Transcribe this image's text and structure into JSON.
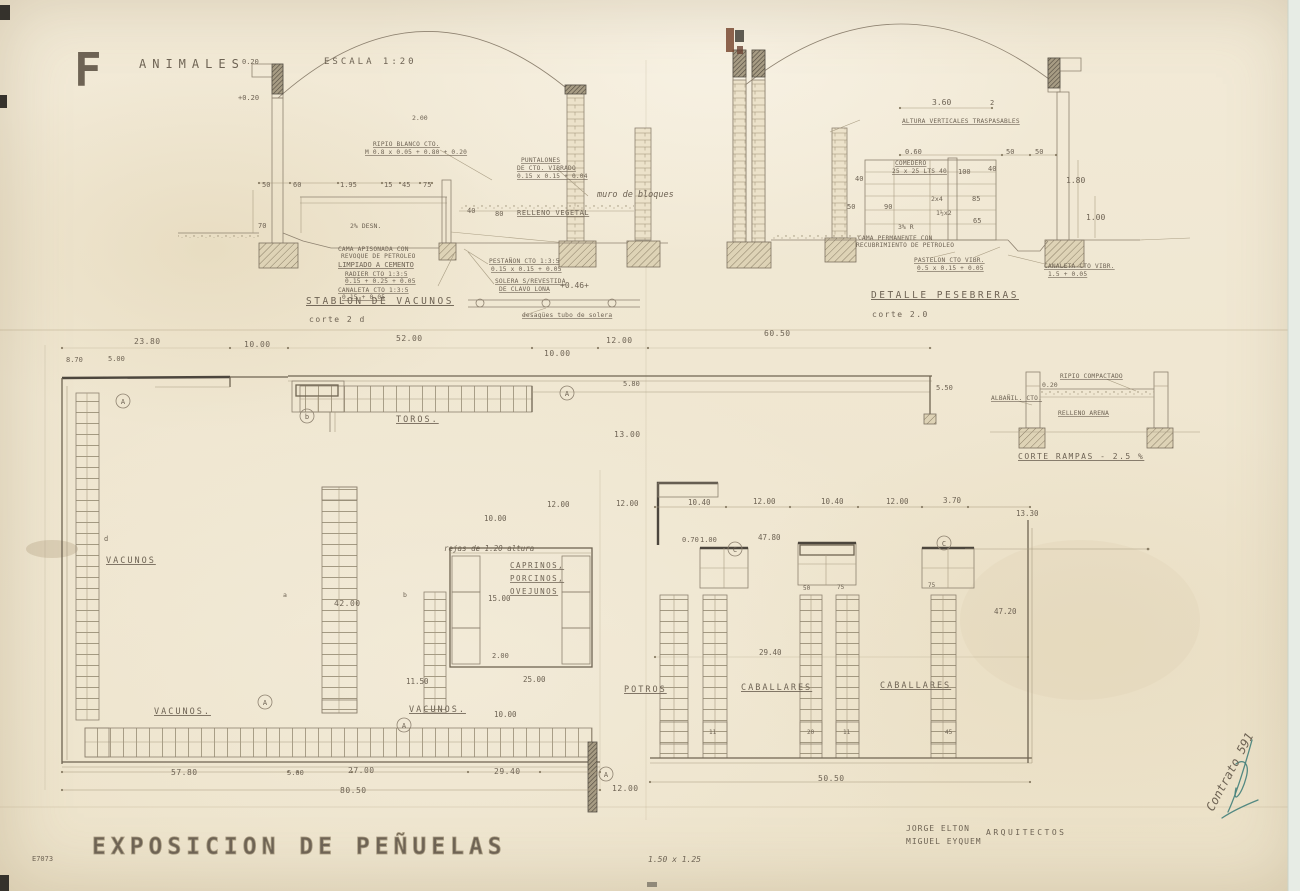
{
  "palette": {
    "paper": "#f1e9d5",
    "ink_faint": "#9b8f77",
    "ink": "#6f6452",
    "dark": "#4c463d",
    "blue_ink": "#43807a",
    "scanner_edge": "#e7ece5"
  },
  "drawing": {
    "header": [
      {
        "n": "sheet-letter",
        "t": "F",
        "x": 74,
        "y": 86,
        "c": "sheet-f"
      },
      {
        "n": "drawing-title",
        "t": "ANIMALES",
        "x": 139,
        "y": 68,
        "c": "head"
      },
      {
        "n": "scale-note",
        "t": "ESCALA  1:20",
        "x": 324,
        "y": 64,
        "c": "head-sm"
      },
      {
        "n": "dim-label",
        "t": "0.20",
        "x": 242,
        "y": 64,
        "c": "tiny"
      },
      {
        "n": "dim-label",
        "t": "+0.20",
        "x": 238,
        "y": 100,
        "c": "tiny"
      }
    ],
    "section_vacunos": [
      {
        "t": "2.00",
        "x": 412,
        "y": 120,
        "c": "tiny-f"
      },
      {
        "n": "note",
        "t": "RIPIO BLANCO CTO.",
        "x": 373,
        "y": 146,
        "c": "ann-u"
      },
      {
        "n": "note",
        "t": "M 0.8 x 0.05 + 0.80 + 0.20",
        "x": 365,
        "y": 154,
        "c": "ann-u"
      },
      {
        "t": "50",
        "x": 262,
        "y": 187,
        "c": "tiny"
      },
      {
        "t": "60",
        "x": 293,
        "y": 187,
        "c": "tiny"
      },
      {
        "t": "1.95",
        "x": 340,
        "y": 187,
        "c": "tiny"
      },
      {
        "t": "15",
        "x": 384,
        "y": 187,
        "c": "tiny"
      },
      {
        "t": "45",
        "x": 402,
        "y": 187,
        "c": "tiny"
      },
      {
        "t": "75",
        "x": 423,
        "y": 187,
        "c": "tiny"
      },
      {
        "t": "70",
        "x": 258,
        "y": 228,
        "c": "tiny"
      },
      {
        "n": "note",
        "t": "PUNTALONES",
        "x": 521,
        "y": 162,
        "c": "ann-u"
      },
      {
        "n": "note",
        "t": "DE CTO. VIBRADO",
        "x": 517,
        "y": 170,
        "c": "ann-u"
      },
      {
        "n": "note",
        "t": "0.15 x 0.15 + 0.04",
        "x": 517,
        "y": 178,
        "c": "ann-u"
      },
      {
        "n": "note-hand",
        "t": "muro de bloques",
        "x": 597,
        "y": 197,
        "c": "hand"
      },
      {
        "t": "40",
        "x": 467,
        "y": 213,
        "c": "tiny"
      },
      {
        "t": "80",
        "x": 495,
        "y": 216,
        "c": "tiny"
      },
      {
        "n": "note",
        "t": "RELLENO VEGETAL",
        "x": 517,
        "y": 215,
        "c": "ann-u7"
      },
      {
        "t": "2% DESN.",
        "x": 350,
        "y": 228,
        "c": "tiny-f"
      },
      {
        "n": "note",
        "t": "CAMA APISONADA CON",
        "x": 338,
        "y": 251,
        "c": "ann"
      },
      {
        "n": "note",
        "t": "REVOQUE DE PETROLEO",
        "x": 341,
        "y": 258,
        "c": "ann"
      },
      {
        "n": "note",
        "t": "LIMPIADO A CEMENTO",
        "x": 338,
        "y": 267,
        "c": "ann-u8"
      },
      {
        "n": "note",
        "t": "RADIER CTO 1:3:5",
        "x": 345,
        "y": 276,
        "c": "ann-u"
      },
      {
        "n": "note",
        "t": "0.15 + 0.25 + 0.05",
        "x": 345,
        "y": 283,
        "c": "ann-u"
      },
      {
        "n": "note",
        "t": "CANALETA CTO 1:3:5",
        "x": 338,
        "y": 292,
        "c": "ann-u"
      },
      {
        "n": "note",
        "t": "0.15 + 0.05",
        "x": 342,
        "y": 299,
        "c": "ann-u"
      },
      {
        "n": "note",
        "t": "PESTAÑON CTO 1:3:5",
        "x": 489,
        "y": 263,
        "c": "ann-u"
      },
      {
        "n": "note",
        "t": "0.15 x 0.15 + 0.05",
        "x": 491,
        "y": 271,
        "c": "ann-u"
      },
      {
        "n": "note",
        "t": "SOLERA S/REVESTIDA",
        "x": 495,
        "y": 283,
        "c": "ann-u"
      },
      {
        "n": "note",
        "t": "DE CLAVO LONA",
        "x": 499,
        "y": 291,
        "c": "ann-u"
      },
      {
        "n": "level-mark",
        "t": "+0.46+",
        "x": 560,
        "y": 288,
        "c": "num8"
      },
      {
        "n": "section-title-vacunos",
        "t": "STABLON DE VACUNOS",
        "x": 306,
        "y": 304,
        "c": "sec-title"
      },
      {
        "n": "section-cut-vacunos",
        "t": "corte 2 d",
        "x": 309,
        "y": 322,
        "c": "sec-sub"
      },
      {
        "n": "note",
        "t": "desagües tubo de solera",
        "x": 522,
        "y": 317,
        "c": "ann-u"
      }
    ],
    "section_pesebreras": [
      {
        "t": "3.60",
        "x": 932,
        "y": 105,
        "c": "num8"
      },
      {
        "t": "2",
        "x": 990,
        "y": 105,
        "c": "tiny"
      },
      {
        "n": "note",
        "t": "ALTURA VERTICALES TRASPASABLES",
        "x": 902,
        "y": 123,
        "c": "ann-u"
      },
      {
        "t": "0.60",
        "x": 905,
        "y": 154,
        "c": "tiny"
      },
      {
        "t": "50",
        "x": 1006,
        "y": 154,
        "c": "tiny"
      },
      {
        "t": "50",
        "x": 1035,
        "y": 154,
        "c": "tiny"
      },
      {
        "n": "note",
        "t": "COMEDERO",
        "x": 895,
        "y": 165,
        "c": "ann-u"
      },
      {
        "n": "note",
        "t": "25 x 25 LTS 40",
        "x": 892,
        "y": 173,
        "c": "ann-u"
      },
      {
        "t": "40",
        "x": 855,
        "y": 181,
        "c": "tiny"
      },
      {
        "t": "100",
        "x": 958,
        "y": 174,
        "c": "tiny"
      },
      {
        "t": "40",
        "x": 988,
        "y": 171,
        "c": "tiny"
      },
      {
        "t": "1.80",
        "x": 1066,
        "y": 183,
        "c": "num8"
      },
      {
        "t": "2x4",
        "x": 931,
        "y": 201,
        "c": "tiny-f"
      },
      {
        "t": "85",
        "x": 972,
        "y": 201,
        "c": "tiny"
      },
      {
        "t": "1½x2",
        "x": 936,
        "y": 215,
        "c": "tiny-f"
      },
      {
        "t": "65",
        "x": 973,
        "y": 223,
        "c": "tiny"
      },
      {
        "t": "50",
        "x": 847,
        "y": 209,
        "c": "tiny"
      },
      {
        "t": "90",
        "x": 884,
        "y": 209,
        "c": "tiny"
      },
      {
        "t": "3% R",
        "x": 898,
        "y": 229,
        "c": "tiny-f"
      },
      {
        "t": "1.00",
        "x": 1086,
        "y": 220,
        "c": "num8"
      },
      {
        "n": "note",
        "t": "CAMA PERMANENTE CON",
        "x": 858,
        "y": 240,
        "c": "ann"
      },
      {
        "n": "note",
        "t": "RECUBRIMIENTO DE PETROLEO",
        "x": 856,
        "y": 247,
        "c": "ann"
      },
      {
        "n": "note",
        "t": "PASTELON CTO VIBR.",
        "x": 914,
        "y": 262,
        "c": "ann-u"
      },
      {
        "n": "note",
        "t": "0.5 x 0.15 + 0.05",
        "x": 917,
        "y": 270,
        "c": "ann-u"
      },
      {
        "n": "note",
        "t": "CANALETA CTO VIBR.",
        "x": 1044,
        "y": 268,
        "c": "ann-u"
      },
      {
        "n": "note",
        "t": "1.5 + 0.05",
        "x": 1048,
        "y": 276,
        "c": "ann-u"
      },
      {
        "n": "section-title-pesebreras",
        "t": "DETALLE PESEBRERAS",
        "x": 871,
        "y": 298,
        "c": "sec-title"
      },
      {
        "n": "section-cut-pesebreras",
        "t": "corte 2.0",
        "x": 872,
        "y": 317,
        "c": "sec-sub"
      }
    ],
    "ramp_detail": [
      {
        "n": "note",
        "t": "RIPIO COMPACTADO",
        "x": 1060,
        "y": 378,
        "c": "ann-u"
      },
      {
        "n": "note",
        "t": "ALBAÑIL. CTO.",
        "x": 991,
        "y": 400,
        "c": "ann-u"
      },
      {
        "n": "note",
        "t": "RELLENO ARENA",
        "x": 1058,
        "y": 415,
        "c": "ann-u"
      },
      {
        "t": "0.20",
        "x": 1042,
        "y": 387,
        "c": "tiny-f"
      },
      {
        "n": "detail-title-rampas",
        "t": "CORTE RAMPAS - 2.5 %",
        "x": 1018,
        "y": 459,
        "c": "sec-title2"
      }
    ],
    "plan_toros": [
      {
        "t": "23.80",
        "x": 134,
        "y": 344,
        "c": "num"
      },
      {
        "t": "8.70",
        "x": 66,
        "y": 362,
        "c": "tiny"
      },
      {
        "t": "5.00",
        "x": 108,
        "y": 361,
        "c": "tiny"
      },
      {
        "t": "10.00",
        "x": 244,
        "y": 347,
        "c": "num"
      },
      {
        "t": "52.00",
        "x": 396,
        "y": 341,
        "c": "num"
      },
      {
        "t": "10.00",
        "x": 544,
        "y": 356,
        "c": "num"
      },
      {
        "t": "12.00",
        "x": 606,
        "y": 343,
        "c": "num"
      },
      {
        "t": "60.50",
        "x": 764,
        "y": 336,
        "c": "num"
      },
      {
        "t": "5.80",
        "x": 623,
        "y": 386,
        "c": "tiny"
      },
      {
        "t": "5.50",
        "x": 936,
        "y": 390,
        "c": "tiny"
      },
      {
        "t": "13.00",
        "x": 614,
        "y": 437,
        "c": "num"
      },
      {
        "n": "plan-label-toros",
        "t": "TOROS.",
        "x": 396,
        "y": 422,
        "c": "plan-lbl"
      }
    ],
    "plan_vacunos": [
      {
        "n": "plan-label-vacunos-west",
        "t": "VACUNOS",
        "x": 106,
        "y": 563,
        "c": "plan-lbl"
      },
      {
        "t": "d",
        "x": 104,
        "y": 541,
        "c": "tiny"
      },
      {
        "t": "42.00",
        "x": 334,
        "y": 606,
        "c": "num"
      },
      {
        "t": "a",
        "x": 283,
        "y": 597,
        "c": "tiny-f"
      },
      {
        "t": "b",
        "x": 403,
        "y": 597,
        "c": "tiny-f"
      },
      {
        "n": "note-hand",
        "t": "rejas de 1.20 altura",
        "x": 444,
        "y": 551,
        "c": "hand7"
      },
      {
        "n": "plan-label-caprinos",
        "t": "CAPRINOS,",
        "x": 510,
        "y": 568,
        "c": "plan-lbl-u"
      },
      {
        "n": "plan-label-porcinos",
        "t": "PORCINOS,",
        "x": 510,
        "y": 581,
        "c": "plan-lbl-u"
      },
      {
        "n": "plan-label-ovejunos",
        "t": "OVEJUNOS",
        "x": 510,
        "y": 594,
        "c": "plan-lbl-u"
      },
      {
        "t": "10.00",
        "x": 484,
        "y": 521,
        "c": "num-s"
      },
      {
        "t": "12.00",
        "x": 547,
        "y": 507,
        "c": "num-s"
      },
      {
        "t": "12.00",
        "x": 616,
        "y": 506,
        "c": "num-s"
      },
      {
        "t": "15.00",
        "x": 488,
        "y": 601,
        "c": "num-s"
      },
      {
        "t": "2.00",
        "x": 492,
        "y": 658,
        "c": "tiny"
      },
      {
        "t": "11.50",
        "x": 406,
        "y": 684,
        "c": "num-s"
      },
      {
        "t": "25.00",
        "x": 523,
        "y": 682,
        "c": "num-s"
      },
      {
        "n": "plan-label-vacunos-south-1",
        "t": "VACUNOS.",
        "x": 154,
        "y": 714,
        "c": "plan-lbl"
      },
      {
        "n": "plan-label-vacunos-south-2",
        "t": "VACUNOS.",
        "x": 409,
        "y": 712,
        "c": "plan-lbl"
      },
      {
        "t": "10.00",
        "x": 494,
        "y": 717,
        "c": "num-s"
      },
      {
        "t": "57.80",
        "x": 171,
        "y": 775,
        "c": "num"
      },
      {
        "t": "5.60",
        "x": 287,
        "y": 775,
        "c": "tiny"
      },
      {
        "t": "27.00",
        "x": 348,
        "y": 773,
        "c": "num"
      },
      {
        "t": "29.40",
        "x": 494,
        "y": 774,
        "c": "num"
      },
      {
        "t": "80.50",
        "x": 340,
        "y": 793,
        "c": "num"
      },
      {
        "t": "12.00",
        "x": 612,
        "y": 791,
        "c": "num"
      }
    ],
    "plan_caballerizas": [
      {
        "t": "10.40",
        "x": 688,
        "y": 505,
        "c": "num-s"
      },
      {
        "t": "12.00",
        "x": 753,
        "y": 504,
        "c": "num-s"
      },
      {
        "t": "10.40",
        "x": 821,
        "y": 504,
        "c": "num-s"
      },
      {
        "t": "12.00",
        "x": 886,
        "y": 504,
        "c": "num-s"
      },
      {
        "t": "3.70",
        "x": 943,
        "y": 503,
        "c": "num-s"
      },
      {
        "t": "13.30",
        "x": 1016,
        "y": 516,
        "c": "num-s"
      },
      {
        "t": "0.70",
        "x": 682,
        "y": 542,
        "c": "tiny"
      },
      {
        "t": "1.00",
        "x": 700,
        "y": 542,
        "c": "tiny"
      },
      {
        "t": "47.80",
        "x": 758,
        "y": 540,
        "c": "num-s"
      },
      {
        "t": "47.20",
        "x": 994,
        "y": 614,
        "c": "num-s"
      },
      {
        "t": "29.40",
        "x": 759,
        "y": 655,
        "c": "num-s"
      },
      {
        "n": "plan-label-potros",
        "t": "POTROS",
        "x": 624,
        "y": 692,
        "c": "plan-lbl"
      },
      {
        "n": "plan-label-caballares-1",
        "t": "CABALLARES",
        "x": 741,
        "y": 690,
        "c": "plan-lbl"
      },
      {
        "n": "plan-label-caballares-2",
        "t": "CABALLARES",
        "x": 880,
        "y": 688,
        "c": "plan-lbl"
      },
      {
        "t": "50.50",
        "x": 818,
        "y": 781,
        "c": "num"
      },
      {
        "t": "50",
        "x": 803,
        "y": 590,
        "c": "micro"
      },
      {
        "t": "75",
        "x": 837,
        "y": 589,
        "c": "micro"
      },
      {
        "t": "75",
        "x": 928,
        "y": 587,
        "c": "micro"
      },
      {
        "t": "11",
        "x": 709,
        "y": 734,
        "c": "micro"
      },
      {
        "t": "20",
        "x": 807,
        "y": 734,
        "c": "micro"
      },
      {
        "t": "11",
        "x": 843,
        "y": 734,
        "c": "micro"
      },
      {
        "t": "45",
        "x": 945,
        "y": 734,
        "c": "micro"
      }
    ],
    "ref_bubbles": [
      {
        "n": "ref-bubble-label",
        "t": "A",
        "x": 567,
        "y": 396,
        "c": "circ"
      },
      {
        "n": "ref-bubble-label",
        "t": "b",
        "x": 307,
        "y": 419,
        "c": "circ"
      },
      {
        "n": "ref-bubble-label",
        "t": "A",
        "x": 123,
        "y": 404,
        "c": "circ"
      },
      {
        "n": "ref-bubble-label",
        "t": "A",
        "x": 265,
        "y": 705,
        "c": "circ"
      },
      {
        "n": "ref-bubble-label",
        "t": "A",
        "x": 404,
        "y": 728,
        "c": "circ"
      },
      {
        "n": "ref-bubble-label",
        "t": "A",
        "x": 606,
        "y": 777,
        "c": "circ"
      },
      {
        "n": "ref-bubble-label",
        "t": "C",
        "x": 735,
        "y": 552,
        "c": "circ"
      },
      {
        "n": "ref-bubble-label",
        "t": "C",
        "x": 944,
        "y": 546,
        "c": "circ"
      }
    ],
    "footer": [
      {
        "n": "project-title",
        "t": "EXPOSICION  DE  PEÑUELAS",
        "x": 92,
        "y": 854,
        "c": "stencil"
      },
      {
        "n": "architect-name-1",
        "t": "JORGE ELTON",
        "x": 906,
        "y": 831,
        "c": "credit"
      },
      {
        "n": "architect-name-2",
        "t": "MIGUEL EYQUEM",
        "x": 906,
        "y": 844,
        "c": "credit"
      },
      {
        "n": "architects-role",
        "t": "ARQUITECTOS",
        "x": 986,
        "y": 835,
        "c": "credit-ls"
      },
      {
        "n": "sheet-size-note",
        "t": "1.50 x 1.25",
        "x": 648,
        "y": 862,
        "c": "pencil"
      },
      {
        "n": "contract-note",
        "t": "Contrato 591",
        "x": 0,
        "y": 0,
        "c": "ink",
        "tr": "translate(1213,812) rotate(-62)"
      },
      {
        "n": "archive-mark",
        "t": "E7073",
        "x": 32,
        "y": 861,
        "c": "pencil-s"
      }
    ]
  }
}
